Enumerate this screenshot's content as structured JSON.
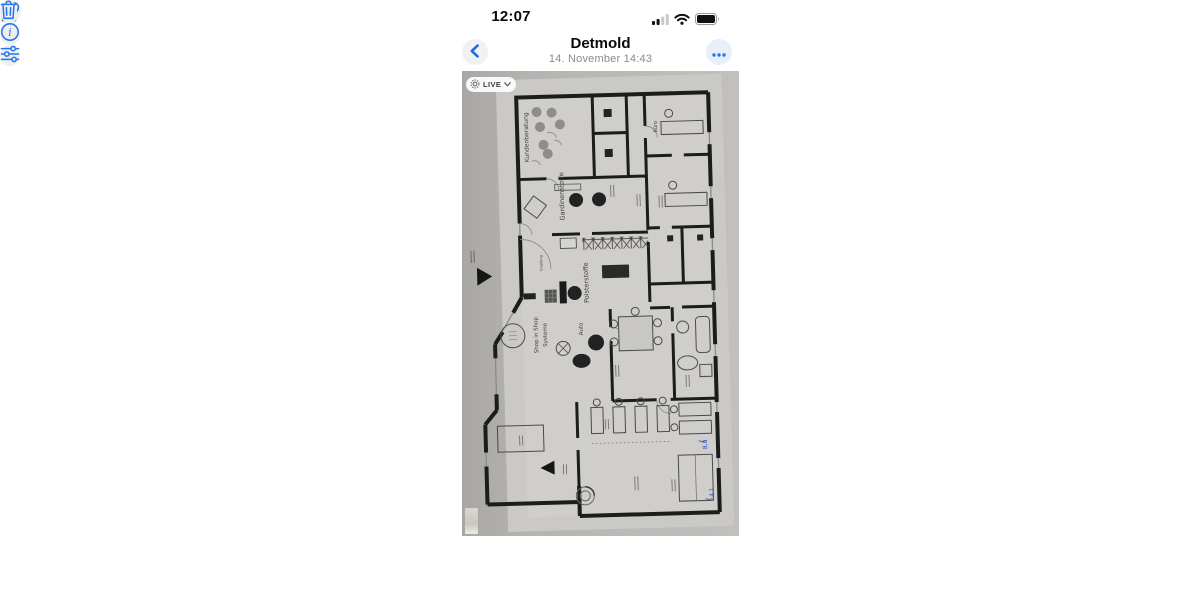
{
  "status_bar": {
    "time": "12:07",
    "icons": {
      "signal": "cellular-signal-icon",
      "wifi": "wifi-icon",
      "battery": "battery-full-icon"
    }
  },
  "header": {
    "title": "Detmold",
    "subtitle": "14. November 14:43",
    "back_icon": "chevron-left",
    "more_icon": "ellipsis"
  },
  "photo": {
    "live_badge": {
      "label": "LIVE",
      "icon": "live-photo-icon",
      "chevron": "chevron-down"
    },
    "floor_plan_labels": {
      "kundenberatung": "Kundenberatung",
      "gardinenstoffe": "Gardinenstoffe",
      "polsterstoffe": "Polsterstoffe",
      "shop_in_shop_line1": "Shop in Shop",
      "shop_in_shop_line2": "Systeme",
      "auto": "Auto",
      "buero": "Büro",
      "empfang": "Empfang"
    },
    "handwritten_annotations": [
      "8,0",
      "4,1"
    ]
  },
  "toolbar": {
    "share": "share-icon",
    "favorite": "heart-icon",
    "info": "info-icon",
    "adjust": "sliders-icon",
    "delete": "trash-icon"
  },
  "colors": {
    "accent_blue": "#2277f0",
    "paper_gray": "#cbc9c6",
    "background_gray": "#b2b0ad",
    "wall_black": "#1c1c1c",
    "annotation_blue": "#2b4bd4"
  }
}
